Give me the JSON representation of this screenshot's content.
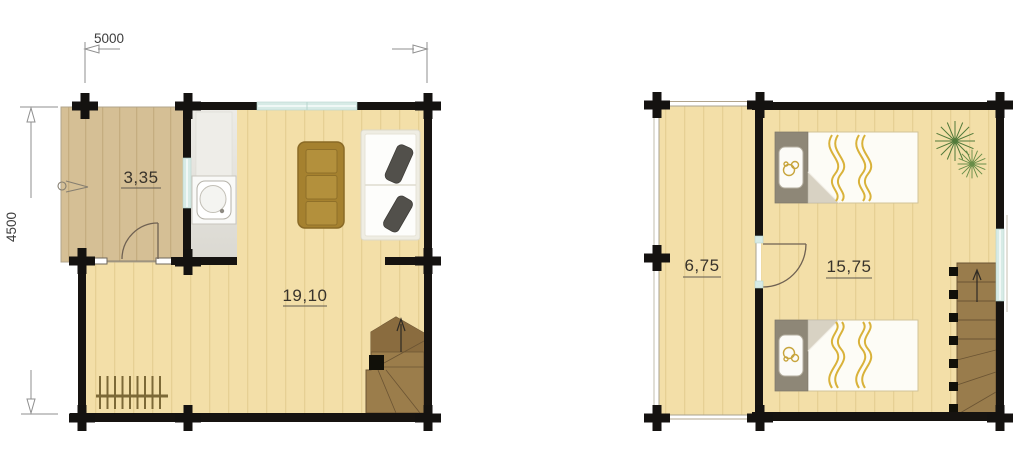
{
  "plans": {
    "ground_floor": {
      "rooms": {
        "porch": "3,35",
        "living": "19,10"
      },
      "symbols": [
        "entrance-arrow",
        "door-swing",
        "kitchenette-sink",
        "dining-table",
        "sofa",
        "radiator",
        "winder-stairs",
        "window"
      ]
    },
    "upper_floor": {
      "rooms": {
        "landing": "6,75",
        "bedroom": "15,75"
      },
      "symbols": [
        "door-swing",
        "single-bed",
        "single-bed",
        "plant",
        "winder-stairs",
        "window"
      ]
    }
  },
  "dimensions": {
    "width": "5000",
    "depth": "4500"
  },
  "colors": {
    "floor": "#f3dfa8",
    "porch_floor": "#d5bf95",
    "wall": "#161310",
    "window_glass": "#d7ebe6",
    "stairs": "#9b7d4b",
    "table": "#a5812f",
    "bed_accent": "#d9b23a",
    "plant": "#527a3a"
  }
}
